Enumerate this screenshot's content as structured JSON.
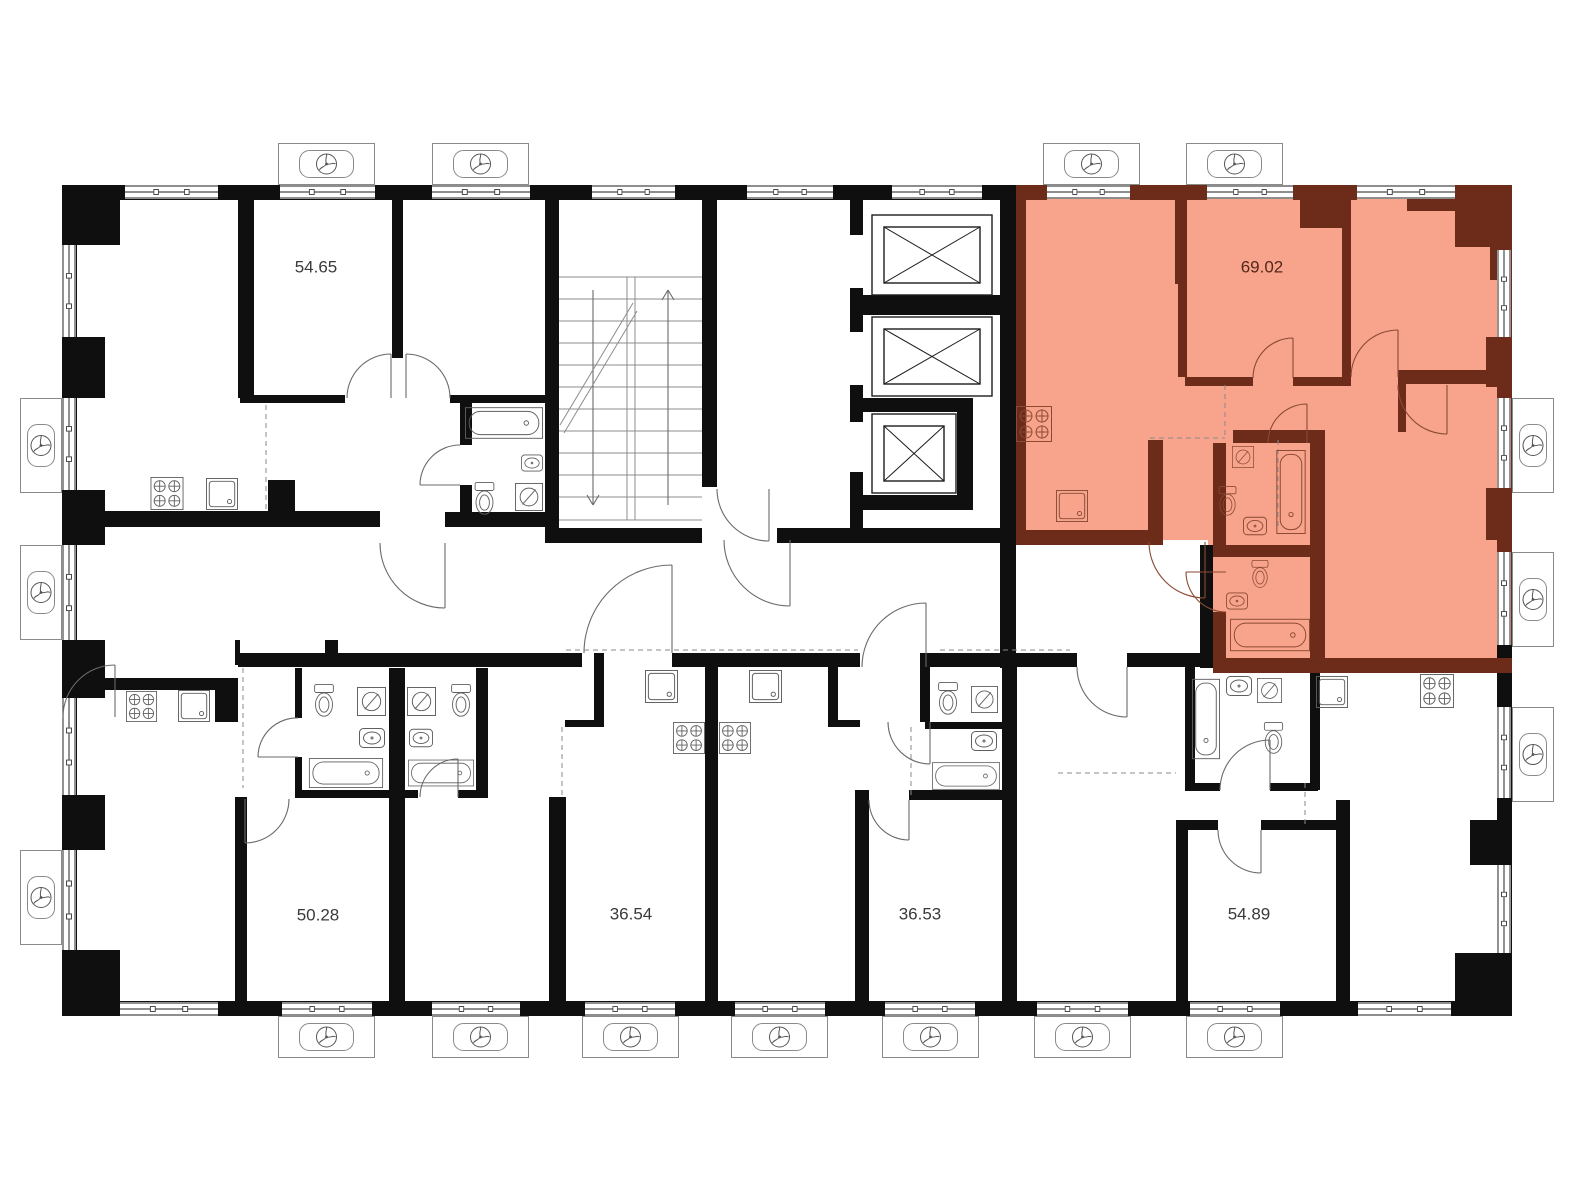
{
  "document": {
    "kind": "residential floor plan"
  },
  "apartments": [
    {
      "name": "apartment-54-65",
      "area": "54.65",
      "highlighted": false
    },
    {
      "name": "apartment-69-02",
      "area": "69.02",
      "highlighted": true
    },
    {
      "name": "apartment-50-28",
      "area": "50.28",
      "highlighted": false
    },
    {
      "name": "apartment-36-54",
      "area": "36.54",
      "highlighted": false
    },
    {
      "name": "apartment-36-53",
      "area": "36.53",
      "highlighted": false
    },
    {
      "name": "apartment-54-89",
      "area": "54.89",
      "highlighted": false
    }
  ],
  "colors": {
    "background": "#ffffff",
    "wall": "#0f0f0f",
    "highlight_fill": "#f8a38c",
    "highlight_wall": "#6d2b1a",
    "fixture_stroke": "#5f5f5f",
    "highlight_fixture_stroke": "#8a4a33",
    "area_label": "#3a3a3a",
    "highlight_area_label": "#54281a"
  },
  "icons": {
    "fan": "fan-icon",
    "stove": "stove-burners-icon",
    "kitchen_sink": "kitchen-sink-icon",
    "washbasin": "washbasin-icon",
    "toilet": "toilet-icon",
    "washing_machine": "washing-machine-icon",
    "bathtub": "bathtub-icon",
    "elevator": "elevator-shaft-icon",
    "staircase": "staircase-icon",
    "window": "window-icon",
    "door": "door-swing-icon"
  }
}
